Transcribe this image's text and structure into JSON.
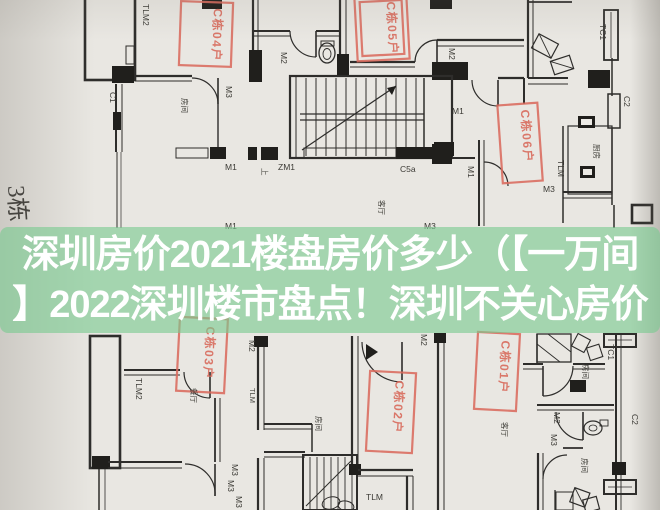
{
  "overlay": {
    "line1": "深圳房价2021楼盘房价多少（【一万间",
    "line2": "】2022深圳楼市盘点！深圳不关心房价",
    "band_color": "#79ca90",
    "text_color": "#ffffff"
  },
  "floorplan": {
    "paper_color": "#e9e7e2",
    "line_color": "#2e2d2b",
    "stamp_color": "#d96b5d",
    "building_label": "3栋",
    "stamps": [
      {
        "label": "C栋04户"
      },
      {
        "label": "C栋05户"
      },
      {
        "label": "C栋06户"
      },
      {
        "label": "C栋03户"
      },
      {
        "label": "C栋02户"
      },
      {
        "label": "C栋01户"
      }
    ],
    "labels": [
      {
        "text": "TLM2"
      },
      {
        "text": "C1"
      },
      {
        "text": "M3"
      },
      {
        "text": "房间"
      },
      {
        "text": "M2"
      },
      {
        "text": "M1"
      },
      {
        "text": "ZM1"
      },
      {
        "text": "上"
      },
      {
        "text": "C5a"
      },
      {
        "text": "M1"
      },
      {
        "text": "M2"
      },
      {
        "text": "M1"
      },
      {
        "text": "M3"
      },
      {
        "text": "TC1"
      },
      {
        "text": "C2"
      },
      {
        "text": "TLM"
      },
      {
        "text": "厨房"
      },
      {
        "text": "M1"
      },
      {
        "text": "M3"
      },
      {
        "text": "客厅"
      },
      {
        "text": "TLM2"
      },
      {
        "text": "餐厅"
      },
      {
        "text": "TLM"
      },
      {
        "text": "M2"
      },
      {
        "text": "M3"
      },
      {
        "text": "M3"
      },
      {
        "text": "M3"
      },
      {
        "text": "房间"
      },
      {
        "text": "M2"
      },
      {
        "text": "TLM"
      },
      {
        "text": "客厅"
      },
      {
        "text": "房间"
      },
      {
        "text": "TC1"
      },
      {
        "text": "M2"
      },
      {
        "text": "M3"
      },
      {
        "text": "房间"
      },
      {
        "text": "C2"
      }
    ]
  }
}
